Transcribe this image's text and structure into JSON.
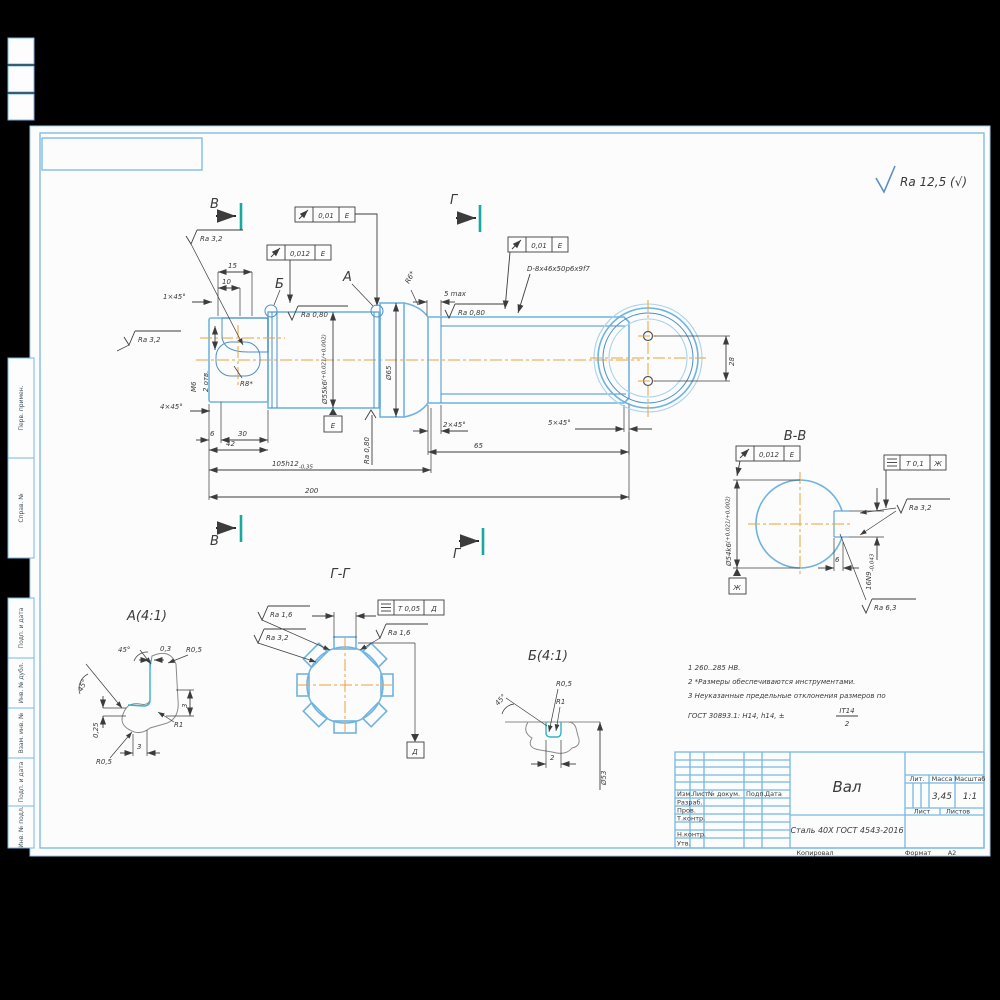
{
  "general_roughness": "Ra 12,5 (√)",
  "margin_strips": [
    "Перв. примен.",
    "Справ. №",
    "Подп. и дата",
    "Инв. № дубл.",
    "Взам. инв. №",
    "Подп. и дата",
    "Инв. № подл."
  ],
  "main_view": {
    "section_b": "В",
    "section_g": "Г",
    "detail_a_ref": "А",
    "detail_b_ref": "Б",
    "runout1": "0,01",
    "runout1_datum": "Е",
    "runout2": "0,012",
    "runout2_datum": "Е",
    "runout3": "0,01",
    "runout3_datum": "Е",
    "ra_top": "Ra 3,2",
    "ra_left": "Ra 3,2",
    "ra_b": "Ra 0,80",
    "ra_spline": "Ra 0,80",
    "ra_bottom": "Ra 0,80",
    "spline_spec": "D-8x46x50p6x9f7",
    "smax": "5 max",
    "r6": "R6*",
    "r8": "R8*",
    "m6": "М6",
    "holes": "2 отв.",
    "dim_15": "15",
    "dim_10": "10",
    "ch_1": "1×45°",
    "ch_4": "4×45°",
    "dim_6": "6",
    "dim_30": "30",
    "dim_42": "42",
    "dim_105": "105h12",
    "dim_105_tol": "-0,35",
    "dim_200": "200",
    "dia_55": "Ø55k6",
    "dia_55_tol": "(+0,021/+0,002)",
    "dia_65": "Ø65",
    "ch_2": "2×45°",
    "dim_65": "65",
    "ch_5": "5×45°",
    "datum_e": "Е",
    "dim_28": "28"
  },
  "section_bb": {
    "title": "В-В",
    "runout": "0,012",
    "runout_datum": "Е",
    "sym_tol": "Т 0,1",
    "sym_datum": "Ж",
    "dia_54": "Ø54k6",
    "dia_54_tol": "(+0,021/+0,002)",
    "ra_side": "Ra 3,2",
    "key_width": "16N9",
    "key_width_tol": "-0,043",
    "dim_6": "6",
    "ra_floor": "Ra 6,3",
    "datum_zh": "Ж"
  },
  "section_gg": {
    "title": "Г-Г",
    "sym_tol": "Т 0,05",
    "sym_datum": "Д",
    "ra_1": "Ra 1,6",
    "ra_2": "Ra 3,2",
    "ra_3": "Ra 1,6",
    "datum_d": "Д"
  },
  "detail_a": {
    "title": "А(4:1)",
    "angle_top": "45°",
    "angle_left": "45°",
    "dim_03": "0,3",
    "r05_top": "R0,5",
    "dim_3v": "3",
    "r1": "R1",
    "dim_025": "0,25",
    "dim_3h": "3",
    "r05_bottom": "R0,5"
  },
  "detail_b": {
    "title": "Б(4:1)",
    "r05": "R0,5",
    "r1": "R1",
    "angle": "45°",
    "dim_2": "2",
    "dia_53": "Ø53"
  },
  "notes": {
    "line1": "1  260..285 НВ.",
    "line2": "2  *Размеры обеспечиваются инструментами.",
    "line3": "3  Неуказанные предельные отклонения размеров по",
    "line4": "ГОСТ 30893.1: Н14, h14, ±",
    "frac_num": "IT14",
    "frac_den": "2"
  },
  "title_block": {
    "part_name": "Вал",
    "material": "Сталь 40Х ГОСТ 4543-2016",
    "mass_value": "3,45",
    "scale_value": "1:1",
    "col_izm": "Изм.",
    "col_list": "Лист",
    "col_doc": "№ докум.",
    "col_podp": "Подп.",
    "col_data": "Дата",
    "row_razrab": "Разраб.",
    "row_prov": "Пров.",
    "row_tkontr": "Т.контр.",
    "row_nkontr": "Н.контр.",
    "row_utv": "Утв.",
    "hdr_lit": "Лит.",
    "hdr_mass": "Масса",
    "hdr_scale": "Масштаб",
    "hdr_list": "Лист",
    "hdr_listov": "Листов",
    "footer_copy": "Копировал",
    "footer_format": "Формат",
    "format_value": "А2"
  }
}
